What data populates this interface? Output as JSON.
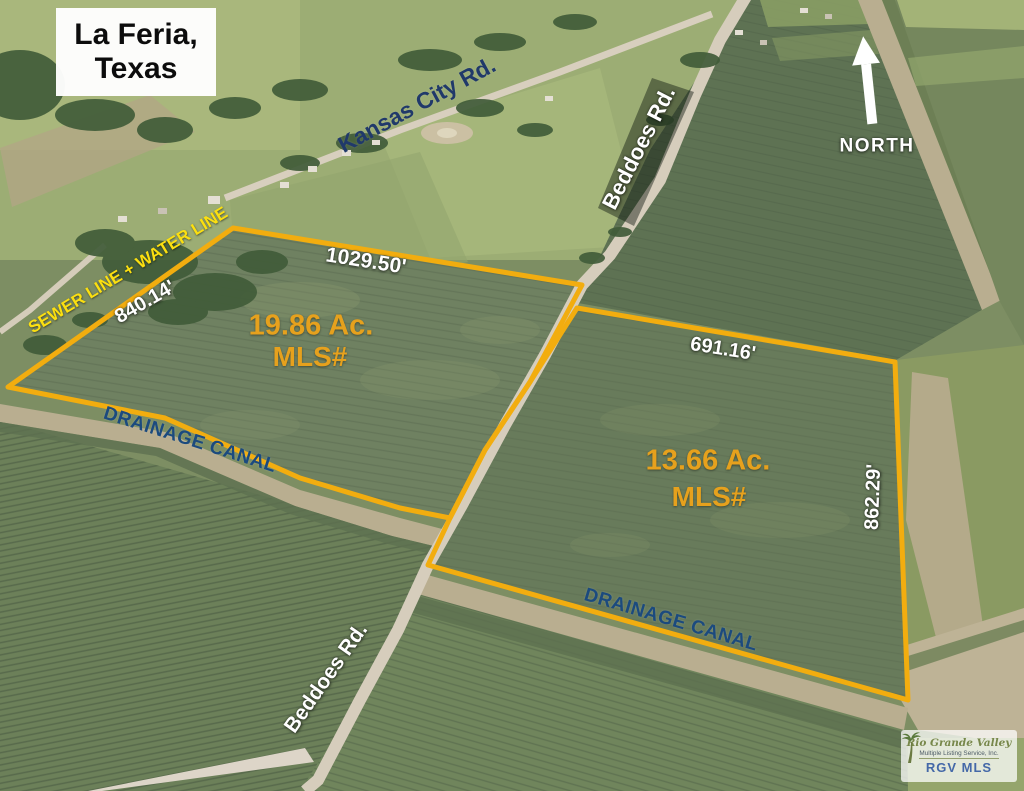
{
  "title": {
    "line1": "La Feria,",
    "line2": "Texas"
  },
  "compass": {
    "label": "NORTH"
  },
  "roads": {
    "kansas_city": "Kansas City Rd.",
    "beddoes_north": "Beddoes Rd.",
    "beddoes_south": "Beddoes Rd."
  },
  "utilities": {
    "sewer_water": "SEWER LINE + WATER LINE"
  },
  "canals": {
    "canal_1": "DRAINAGE CANAL",
    "canal_2": "DRAINAGE CANAL"
  },
  "parcels": {
    "left": {
      "area": "19.86 Ac.",
      "mls": "MLS#",
      "north_len": "1029.50'",
      "west_len": "840.14'"
    },
    "right": {
      "area": "13.66 Ac.",
      "mls": "MLS#",
      "north_len": "691.16'",
      "east_len": "862.29'"
    }
  },
  "watermark": {
    "brand": "Rio Grande Valley",
    "subtitle": "Multiple Listing Service, Inc.",
    "abbr": "RGV MLS"
  },
  "colors": {
    "boundary_yellow": "#f2ad0f",
    "parcel_label_orange": "#e6a11d",
    "road_label_navy": "#20396a",
    "canal_label_blue": "#1b4a7e",
    "utility_label_yellow": "#fbdf10"
  }
}
